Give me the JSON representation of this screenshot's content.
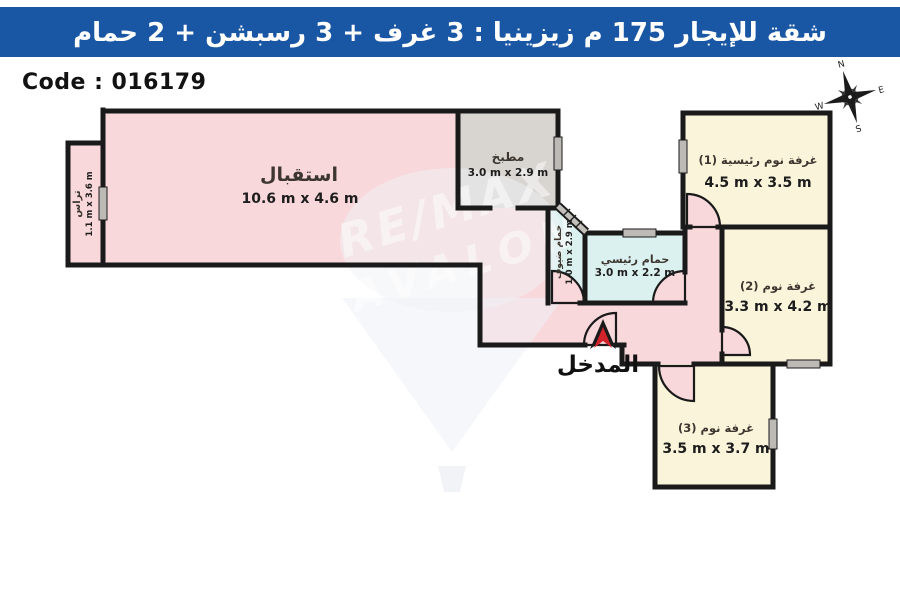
{
  "header": {
    "title": "شقة للإيجار 175 م زيزينيا : 3 غرف + 3 رسبشن + 2 حمام",
    "bg_color": "#1956a4",
    "text_color": "#ffffff"
  },
  "code_label": "Code : 016179",
  "entrance_label": "المدخل",
  "compass": {
    "north": "N",
    "east": "E",
    "south": "S",
    "west": "W"
  },
  "watermark": {
    "line1": "RE/MAX",
    "line2": "AVALON"
  },
  "colors": {
    "wall": "#1a1a1a",
    "room_pink": "#f8d8da",
    "room_cream": "#f9f4da",
    "room_cyan": "#dbf1ef",
    "room_gray": "#d8d4d0",
    "window_gray": "#bdb9b5",
    "arrow_red": "#d2232a"
  },
  "rooms": {
    "reception": {
      "name": "استقبال",
      "dims": "10.6 m x 4.6 m"
    },
    "terrace": {
      "name": "تراس",
      "dims": "1.1 m x 3.6 m"
    },
    "kitchen": {
      "name": "مطبخ",
      "dims": "3.0 m x 2.9 m"
    },
    "guest_bath": {
      "name": "حمام ضيوف",
      "dims": "1.0 m x 2.9 m"
    },
    "main_bath": {
      "name": "حمام رئيسي",
      "dims": "3.0 m x 2.2 m"
    },
    "bedroom1": {
      "name": "غرفة نوم رئيسية (1)",
      "dims": "4.5 m x 3.5 m"
    },
    "bedroom2": {
      "name": "غرفة نوم (2)",
      "dims": "3.3 m x 4.2 m"
    },
    "bedroom3": {
      "name": "غرفة نوم (3)",
      "dims": "3.5 m x 3.7 m"
    }
  }
}
